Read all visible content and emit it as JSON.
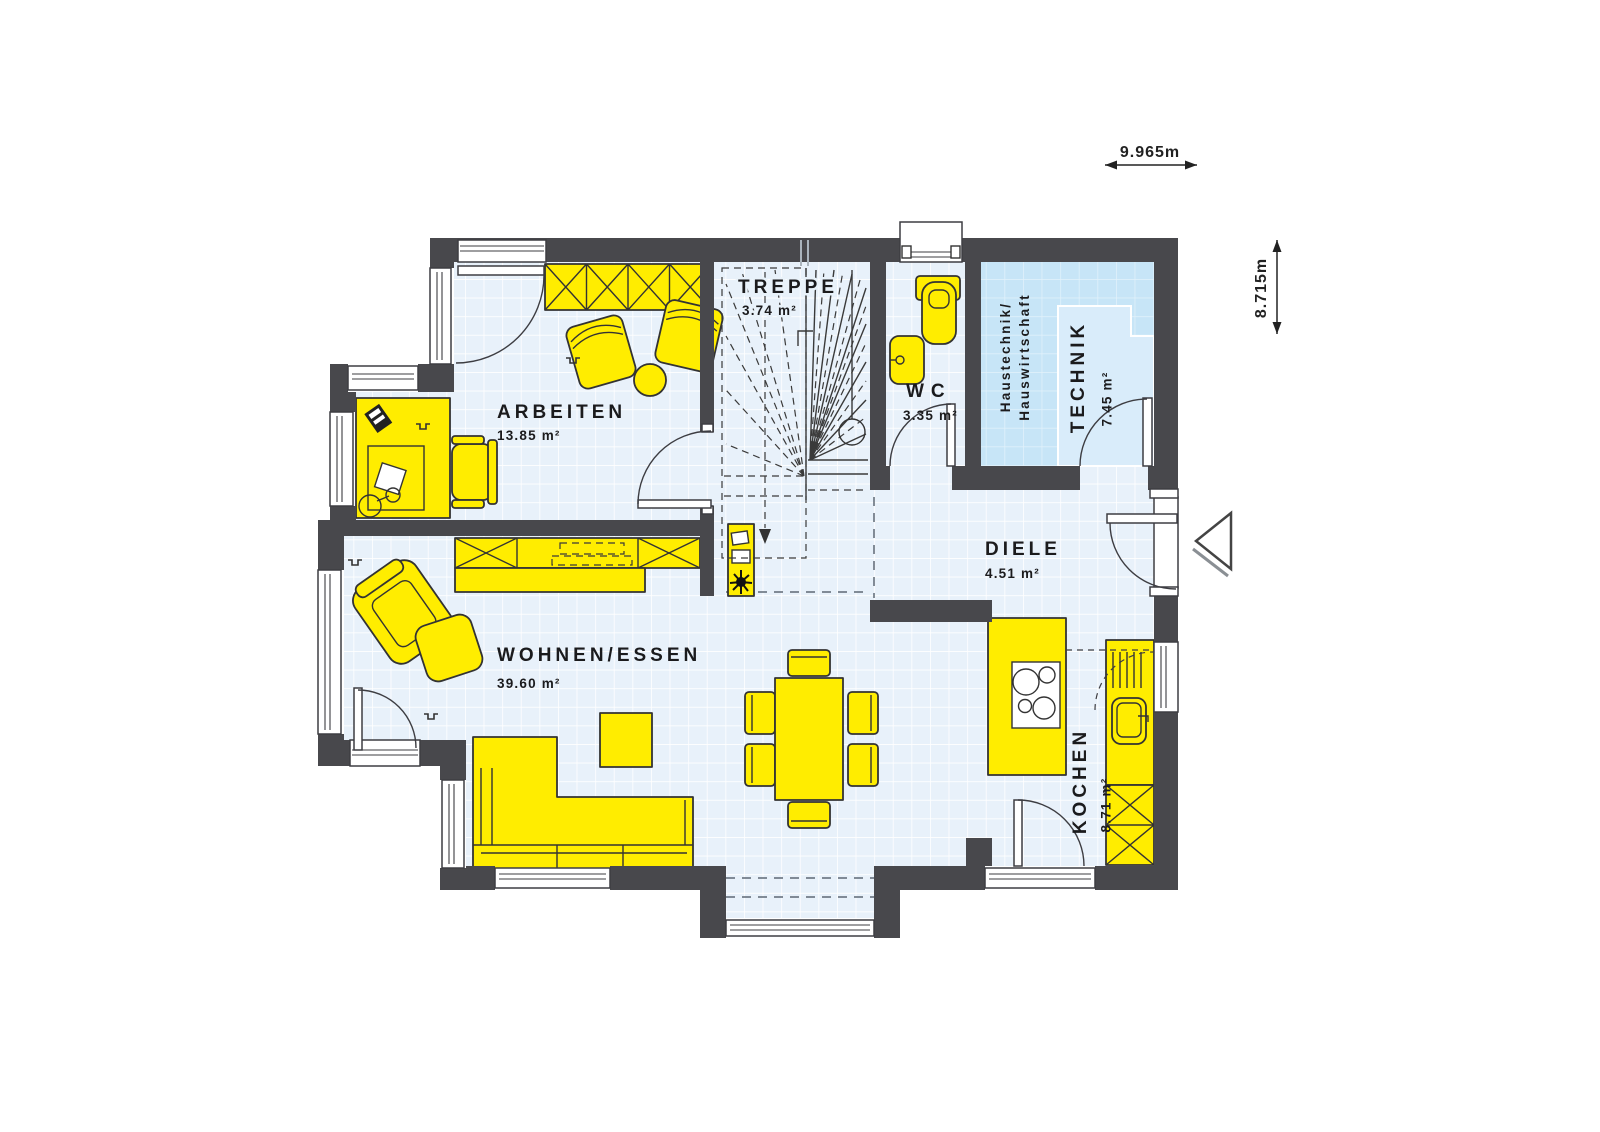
{
  "plan": {
    "dimensions": {
      "width": "9.965m",
      "height": "8.715m"
    },
    "rooms": {
      "arbeiten": {
        "name": "ARBEITEN",
        "area": "13.85 m²"
      },
      "treppe": {
        "name": "TREPPE",
        "area": "3.74 m²"
      },
      "wc": {
        "name": "WC",
        "area": "3.35 m²"
      },
      "technik": {
        "name": "TECHNIK",
        "area": "7.45 m²",
        "sublabel_line1": "Haustechnik/",
        "sublabel_line2": "Hauswirtschaft"
      },
      "diele": {
        "name": "DIELE",
        "area": "4.51 m²"
      },
      "wohnen_essen": {
        "name": "WOHNEN/ESSEN",
        "area": "39.60 m²"
      },
      "kochen": {
        "name": "KOCHEN",
        "area": "8.71 m²"
      }
    },
    "colors": {
      "wall": "#48484c",
      "furniture": "#ffed00",
      "technik_room": "#c7e5f7",
      "floor": "#e8f1fa"
    }
  }
}
